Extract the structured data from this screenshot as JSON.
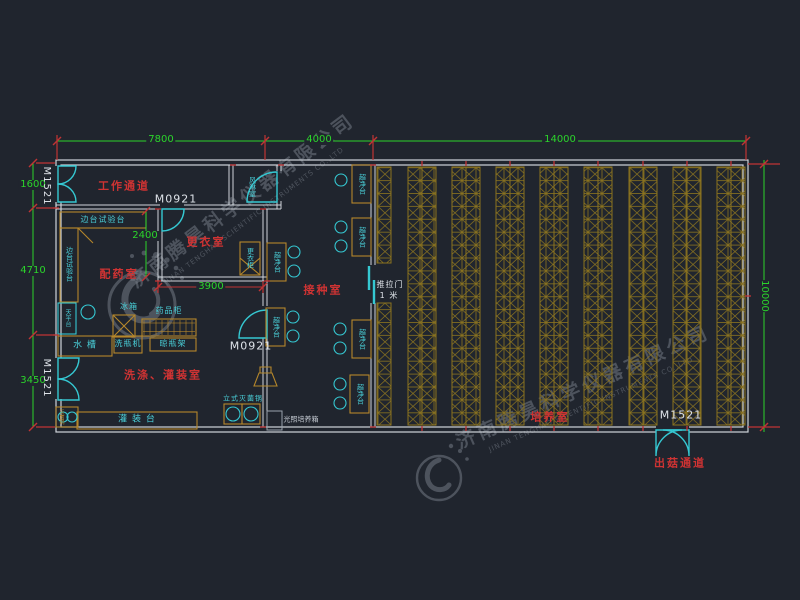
{
  "watermark": {
    "cn": "济南腾昊科学仪器有限公司",
    "en": "JINAN TENGHAO SCIENTIFIC INSTRUMENTS CO.,LTD"
  },
  "dimensions": {
    "top": [
      "7800",
      "4000",
      "14000"
    ],
    "left": [
      "1600",
      "4710",
      "3450"
    ],
    "right": "10000",
    "changing_height": "2400",
    "changing_width": "3900"
  },
  "doors": {
    "double_door": "M1521",
    "single_door": "M0921",
    "sliding_label": "推拉门",
    "sliding_size": "1 米"
  },
  "rooms": {
    "corridor": "工作通道",
    "air_shower": "风淋室",
    "changing": "更衣室",
    "dispensing": "配药室",
    "inoculation": "接种室",
    "washing": "洗涤、灌装室",
    "culture": "培养室",
    "exit_corridor": "出菇通道"
  },
  "furniture": {
    "side_bench": "边台试验台",
    "balance_table": "天平台",
    "fridge": "冰箱",
    "medicine_cabinet": "药品柜",
    "sink": "水 槽",
    "bottle_washer": "洗瓶机",
    "bottle_rack": "晾瓶架",
    "wardrobe": "更衣柜",
    "clean_bench": "超净台",
    "filling_table": "灌 装 台",
    "small_sterilizer": "灭菌锅",
    "sterilizer": "立式灭菌锅",
    "light_incubator": "光照培养箱"
  },
  "colors": {
    "background": "#20252e",
    "wall": "#cfd4da",
    "furniture": "#b5872b",
    "rack": "#8c741f",
    "cyan": "#35c8d2",
    "dimension_green": "#2bd42b",
    "dimension_red": "#c03434",
    "label_red": "#cf3333"
  }
}
